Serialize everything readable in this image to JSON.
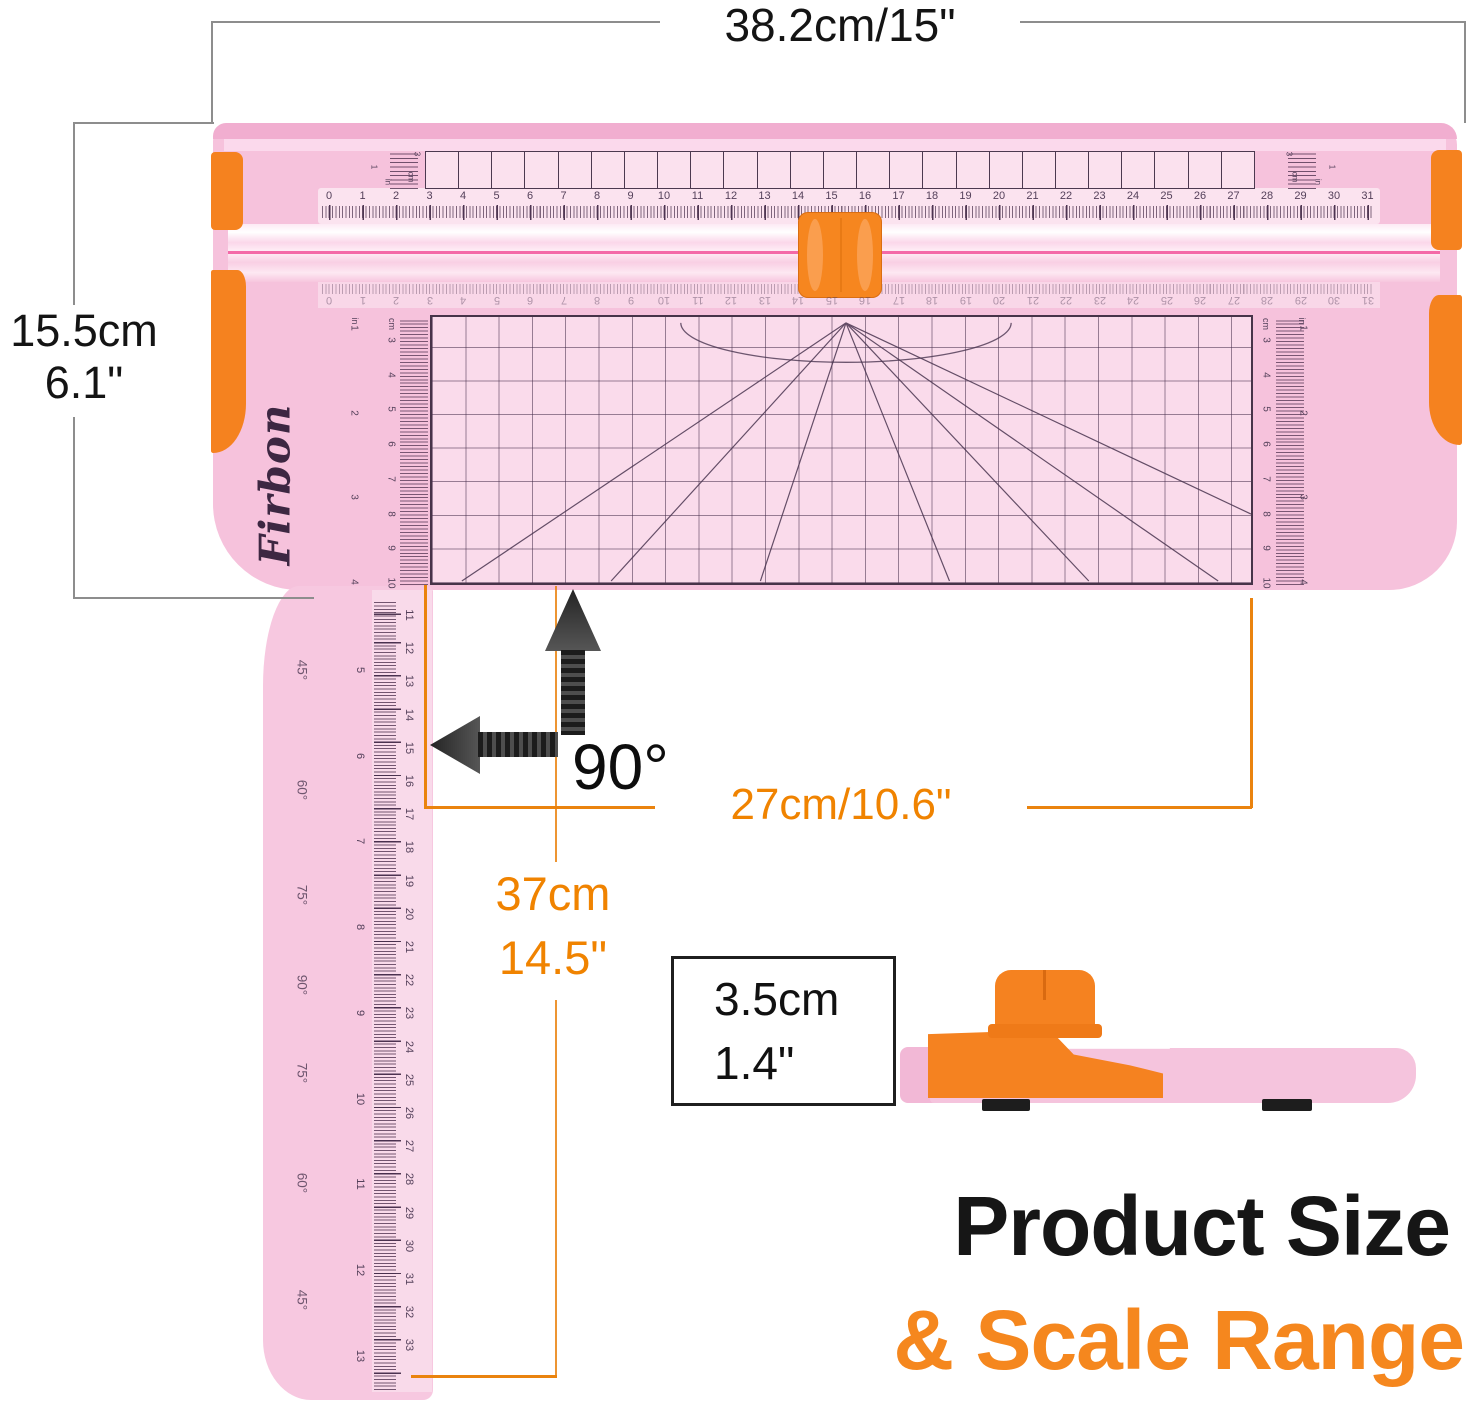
{
  "annotations": {
    "width_top": "38.2cm/15\"",
    "height_left_cm": "15.5cm",
    "height_left_in": "6.1\"",
    "cut_length": "27cm/10.6\"",
    "arm_length_cm": "37cm",
    "arm_length_in": "14.5\"",
    "thickness_cm": "3.5cm",
    "thickness_in": "1.4\"",
    "right_angle": "90°"
  },
  "title": {
    "line1": "Product Size",
    "line2": "& Scale Range"
  },
  "product": {
    "brand": "Firbon",
    "top_ruler_numbers": [
      0,
      1,
      2,
      3,
      4,
      5,
      6,
      7,
      8,
      9,
      10,
      11,
      12,
      13,
      14,
      15,
      16,
      17,
      18,
      19,
      20,
      21,
      22,
      23,
      24,
      25,
      26,
      27,
      28,
      29,
      30,
      31
    ],
    "bottom_ruler_numbers": [
      0,
      1,
      2,
      3,
      4,
      5,
      6,
      7,
      8,
      9,
      10,
      11,
      12,
      13,
      14,
      15,
      16,
      17,
      18,
      19,
      20,
      21,
      22,
      23,
      24,
      25,
      26,
      27,
      28,
      29,
      30,
      31
    ],
    "arm_cm_numbers": [
      11,
      12,
      13,
      14,
      15,
      16,
      17,
      18,
      19,
      20,
      21,
      22,
      23,
      24,
      25,
      26,
      27,
      28,
      29,
      30,
      31,
      32,
      33
    ],
    "arm_inch_numbers": [
      5,
      6,
      7,
      8,
      9,
      10,
      11,
      12,
      13
    ],
    "base_cm_numbers": [
      3,
      4,
      5,
      6,
      7,
      8,
      9,
      10
    ],
    "base_inch_numbers": [
      1,
      2,
      3,
      4
    ],
    "angle_labels": [
      "45°",
      "60°",
      "75°",
      "90°",
      "75°",
      "60°",
      "45°"
    ],
    "mini_scale": {
      "one": "1",
      "three": "3",
      "cm": "cm",
      "in": "in"
    },
    "unit_cm": "cm",
    "unit_in": "in"
  },
  "colors": {
    "body_pink": "#f6c2dc",
    "accent_orange": "#f5821f",
    "dim_line_orange": "#ea830e",
    "dim_text_orange": "#f08300",
    "text_black": "#161616"
  }
}
